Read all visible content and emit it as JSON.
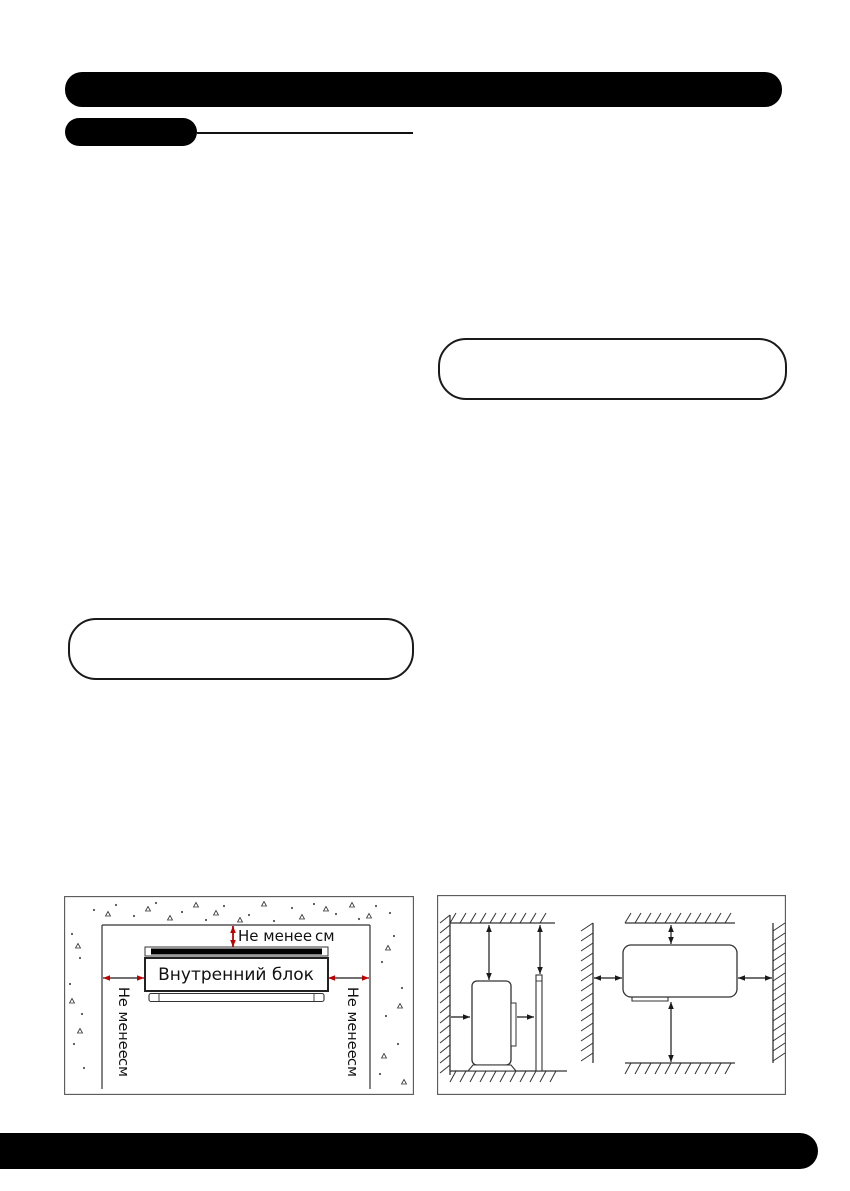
{
  "indoor_figure": {
    "unit_label": "Внутренний блок",
    "top_clearance": {
      "min": "Не менее",
      "unit": "см"
    },
    "left_clearance": {
      "min": "Не менее",
      "unit": "см"
    },
    "right_clearance": {
      "min": "Не менее",
      "unit": "см"
    }
  },
  "colors": {
    "redaction_black": "#000000",
    "arrow_red": "#c00000",
    "line_dark": "#1a1a1a"
  }
}
